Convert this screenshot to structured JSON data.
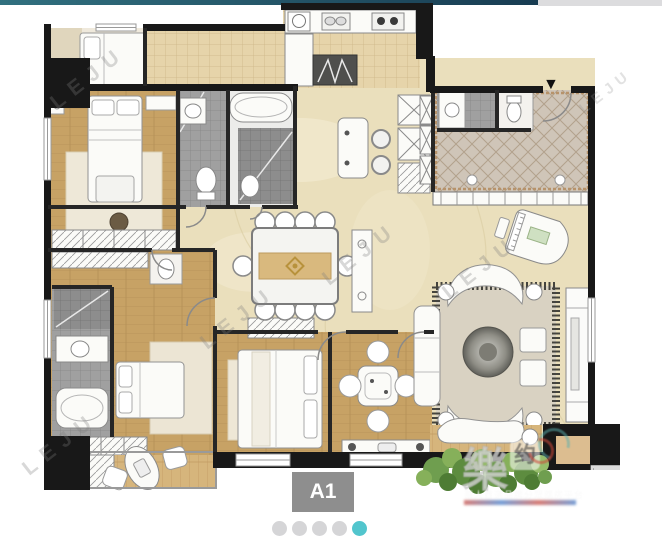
{
  "window": {
    "width": 662,
    "height": 544
  },
  "top_bar": {
    "teal_from": "#31707f",
    "teal_to": "#183c52",
    "gray": "#dcdcde"
  },
  "floor_plan": {
    "description": "apartment floor plan A1",
    "watermark_text": "LEJU",
    "entry_arrow_icon": "▼",
    "logo": {
      "char_left": "樂",
      "char_mid": "约",
      "char_right": "居",
      "subtext": "華人首選品牌分眾購房平台"
    },
    "colors": {
      "wall": "#181818",
      "wood": "#c7a265",
      "wood_light": "#d6b57c",
      "marble": "#eadfbc",
      "kitchen_tile": "#e6d4aa",
      "bath_tile": "#a0a0a0",
      "entry_tile": "#cfc5b8",
      "rug": "#d9d2c2",
      "greenery": "#6f9e4f"
    }
  },
  "unit_label": {
    "text": "A1",
    "bg": "#8e8e8e",
    "color": "#ffffff"
  },
  "carousel": {
    "count": 5,
    "active_index": 4,
    "active_color": "#52c5cd",
    "inactive_color": "#d5d5d7"
  }
}
